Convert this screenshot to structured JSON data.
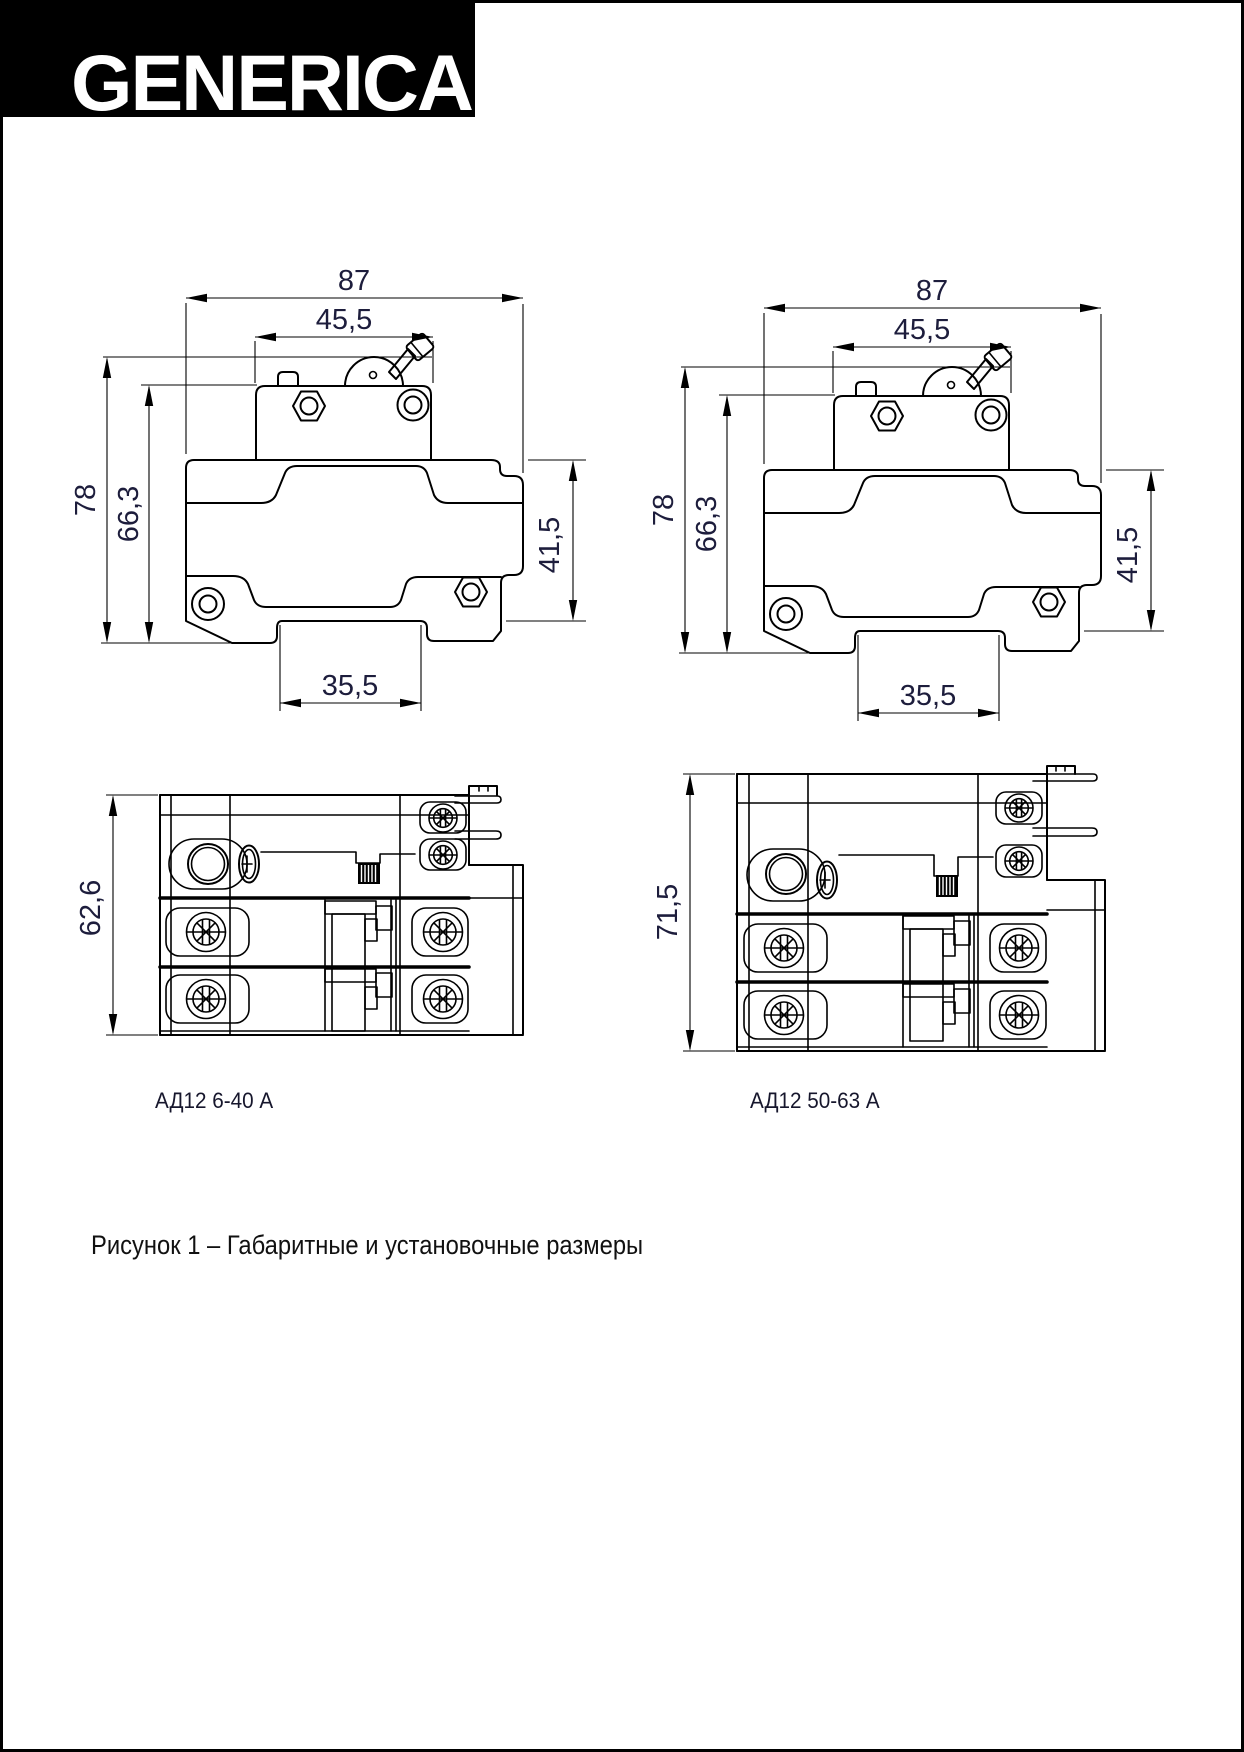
{
  "page": {
    "logo_text": "GENERICA",
    "caption": "Рисунок 1 – Габаритные и установочные размеры"
  },
  "colors": {
    "line": "#000000",
    "dim_text": "#1d1d3c",
    "logo_bg": "#000000",
    "logo_fg": "#ffffff"
  },
  "drawings": {
    "side_left": {
      "dims": {
        "overall_width": "87",
        "top_width": "45,5",
        "overall_height": "78",
        "body_height": "66,3",
        "din_height": "41,5",
        "din_slot_width": "35,5"
      }
    },
    "side_right": {
      "dims": {
        "overall_width": "87",
        "top_width": "45,5",
        "overall_height": "78",
        "body_height": "66,3",
        "din_height": "41,5",
        "din_slot_width": "35,5"
      }
    },
    "bottom_left": {
      "depth": "62,6",
      "label": "АД12 6-40 А"
    },
    "bottom_right": {
      "depth": "71,5",
      "label": "АД12 50-63 А"
    }
  }
}
